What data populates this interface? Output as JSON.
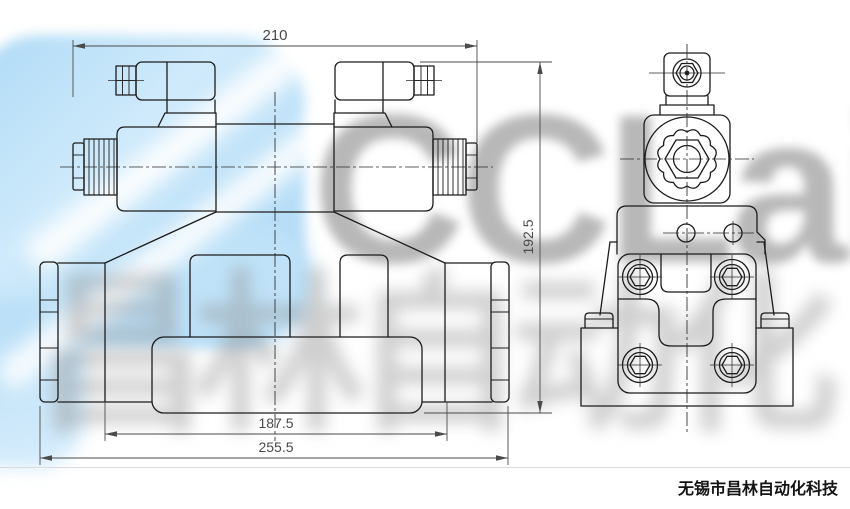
{
  "drawing": {
    "dimensions": {
      "top_width": "210",
      "right_height": "192.5",
      "mid_width": "187.5",
      "bottom_width": "255.5"
    }
  },
  "watermark": {
    "logo_text": "CCLair",
    "cn_text": "昌林自动化"
  },
  "footer": {
    "company": "无锡市昌林自动化科技"
  },
  "colors": {
    "line": "#1c1c1c",
    "dimension": "#4a4a4a",
    "watermark_blue": "#aedaf6",
    "watermark_gray": "#8a8a8a"
  }
}
